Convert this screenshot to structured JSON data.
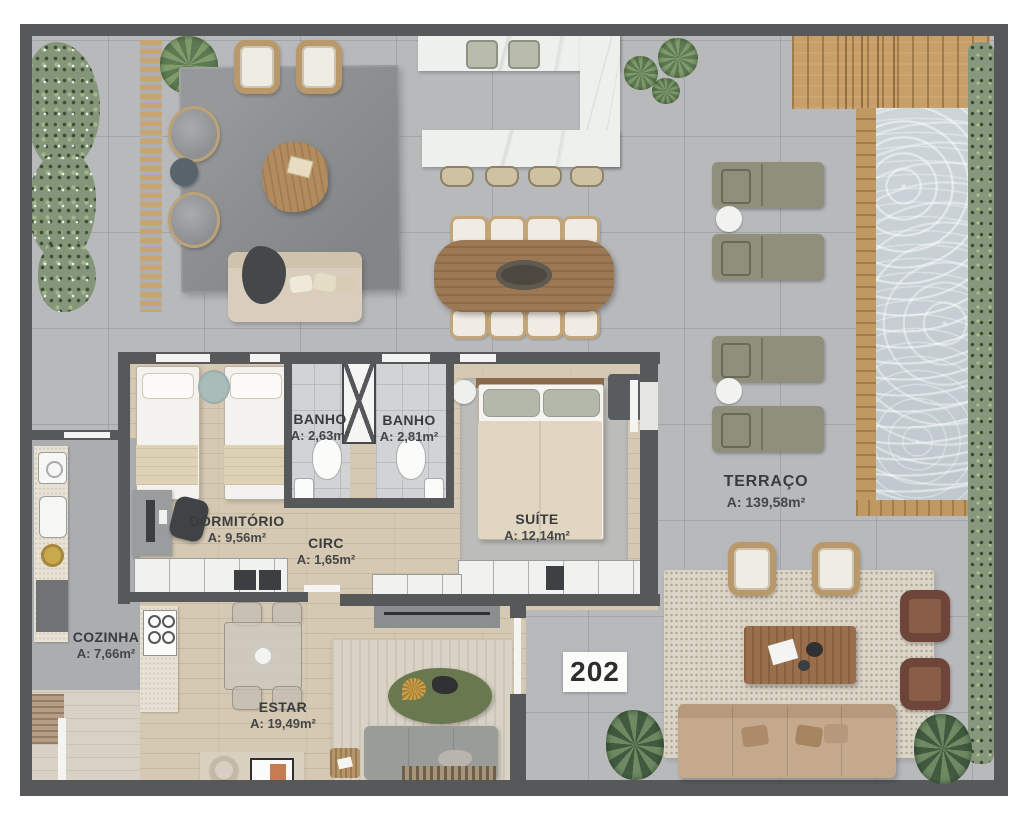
{
  "plan": {
    "unit_badge": "202",
    "rooms": [
      {
        "key": "dormitorio",
        "name": "DORMITÓRIO",
        "area": "A: 9,56m²"
      },
      {
        "key": "banho_1",
        "name": "BANHO",
        "area": "A: 2,63m²"
      },
      {
        "key": "banho_2",
        "name": "BANHO",
        "area": "A: 2,81m²"
      },
      {
        "key": "circ",
        "name": "CIRC",
        "area": "A: 1,65m²"
      },
      {
        "key": "suite",
        "name": "SUÍTE",
        "area": "A: 12,14m²"
      },
      {
        "key": "cozinha",
        "name": "COZINHA",
        "area": "A: 7,66m²"
      },
      {
        "key": "estar",
        "name": "ESTAR",
        "area": "A: 19,49m²"
      },
      {
        "key": "terraco",
        "name": "TERRAÇO",
        "area": "A: 139,58m²"
      }
    ],
    "colors": {
      "wall": "#56585a",
      "terrace_floor": "#b8b9bb",
      "wood_floor": "#d5c9b3",
      "pool_water": "#c6cfd3",
      "deck_wood": "#c89f68",
      "greenery": "#84957a",
      "label_text": "#3a3b3d"
    }
  }
}
